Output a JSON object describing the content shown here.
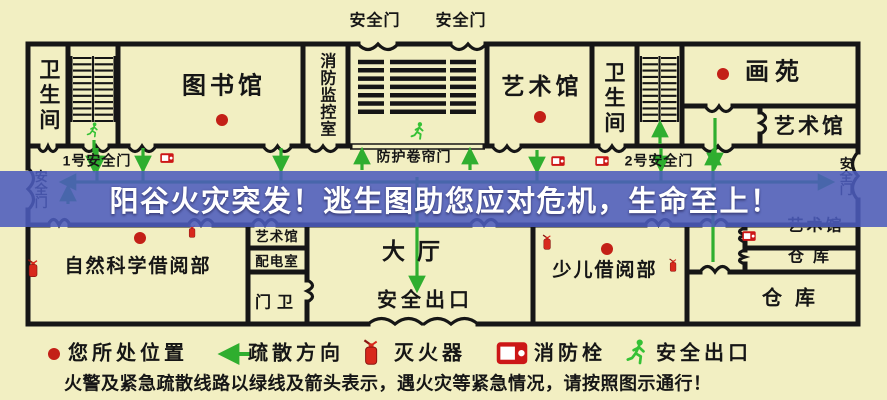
{
  "banner": {
    "text": "阳谷火灾突发！逃生图助您应对危机，生命至上！"
  },
  "map": {
    "top_exit_door_1": "安全门",
    "top_exit_door_2": "安全门",
    "restroom_left": "卫生间",
    "library": "图书馆",
    "fire_control_room": "消防监控室",
    "art_gallery_top": "艺术馆",
    "restroom_right": "卫生间",
    "painting_garden": "画苑",
    "art_gallery_top_right": "艺术馆",
    "exit_door_no1": "1号安全门",
    "fire_shutter_door": "防护卷帘门",
    "exit_door_no2": "2号安全门",
    "exit_door_left": "安全门",
    "exit_door_right": "安全门",
    "natural_science_reading": "自然科学借阅部",
    "art_gallery_mid": "艺术馆",
    "power_distribution_room": "配电室",
    "guard_room": "门卫",
    "main_hall": "大厅",
    "hall_safety_exit": "安全出口",
    "children_reading": "少儿借阅部",
    "art_gallery_right": "艺术馆",
    "warehouse_small": "仓库",
    "warehouse_large": "仓库"
  },
  "legend": {
    "location": "您所处位置",
    "direction": "疏散方向",
    "extinguisher": "灭火器",
    "hydrant": "消防栓",
    "exit": "安全出口",
    "note": "火警及紧急疏散线路以绿线及箭头表示，遇火灾等紧急情况，请按照图示通行！"
  },
  "colors": {
    "background": "#f2efc2",
    "wall": "#161616",
    "arrow_green": "#2fae2f",
    "marker_red": "#c32017",
    "banner_blue": "#4c5cbd",
    "banner_text": "#ffffff"
  }
}
